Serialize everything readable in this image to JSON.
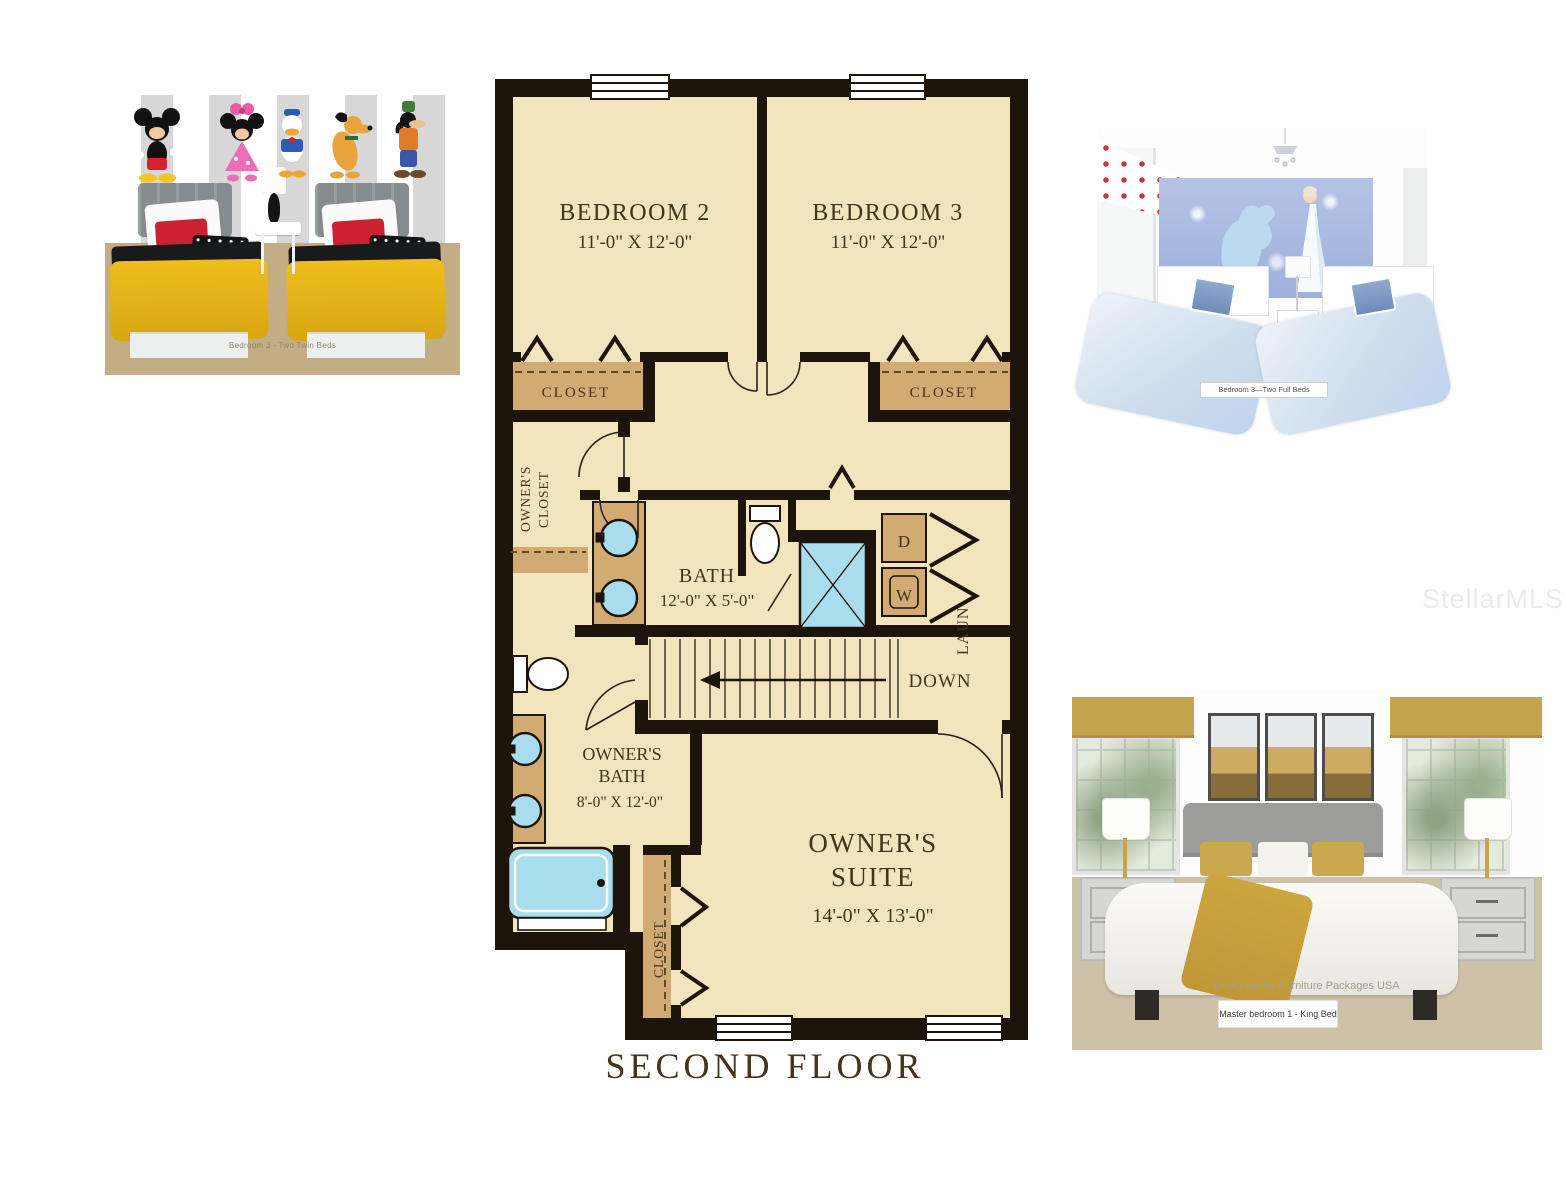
{
  "watermark": "StellarMLS",
  "floor_plan": {
    "title": "SECOND FLOOR",
    "bedroom2_name": "BEDROOM 2",
    "bedroom2_dims": "11'-0\" X 12'-0\"",
    "bedroom3_name": "BEDROOM 3",
    "bedroom3_dims": "11'-0\" X 12'-0\"",
    "closet2": "CLOSET",
    "closet3": "CLOSET",
    "owners_closet_1": "OWNER'S",
    "owners_closet_2": "CLOSET",
    "bath_name": "BATH",
    "bath_dims": "12'-0\" X 5'-0\"",
    "dryer": "D",
    "washer": "W",
    "laundry": "LAUN",
    "down": "DOWN",
    "owners_bath_1": "OWNER'S",
    "owners_bath_2": "BATH",
    "owners_bath_dims": "8'-0\" X 12'-0\"",
    "owners_suite_1": "OWNER'S",
    "owners_suite_2": "SUITE",
    "owners_suite_dims": "14'-0\" X 13'-0\"",
    "suite_closet": "CLOSET"
  },
  "photos": {
    "twin_room_caption": "Bedroom 3 - Two Twin Beds",
    "full_room_caption": "Bedroom 3—Two Full Beds",
    "master_credit": "Designed by Furniture Packages USA",
    "master_caption": "Master bedroom 1 - King Bed"
  },
  "colors": {
    "plan_floor": "#f2e4bd",
    "plan_wall": "#1d150c",
    "closet_fill": "#d2ab73",
    "fixture_blue": "#a9dcec",
    "label_brown": "#43341a"
  }
}
